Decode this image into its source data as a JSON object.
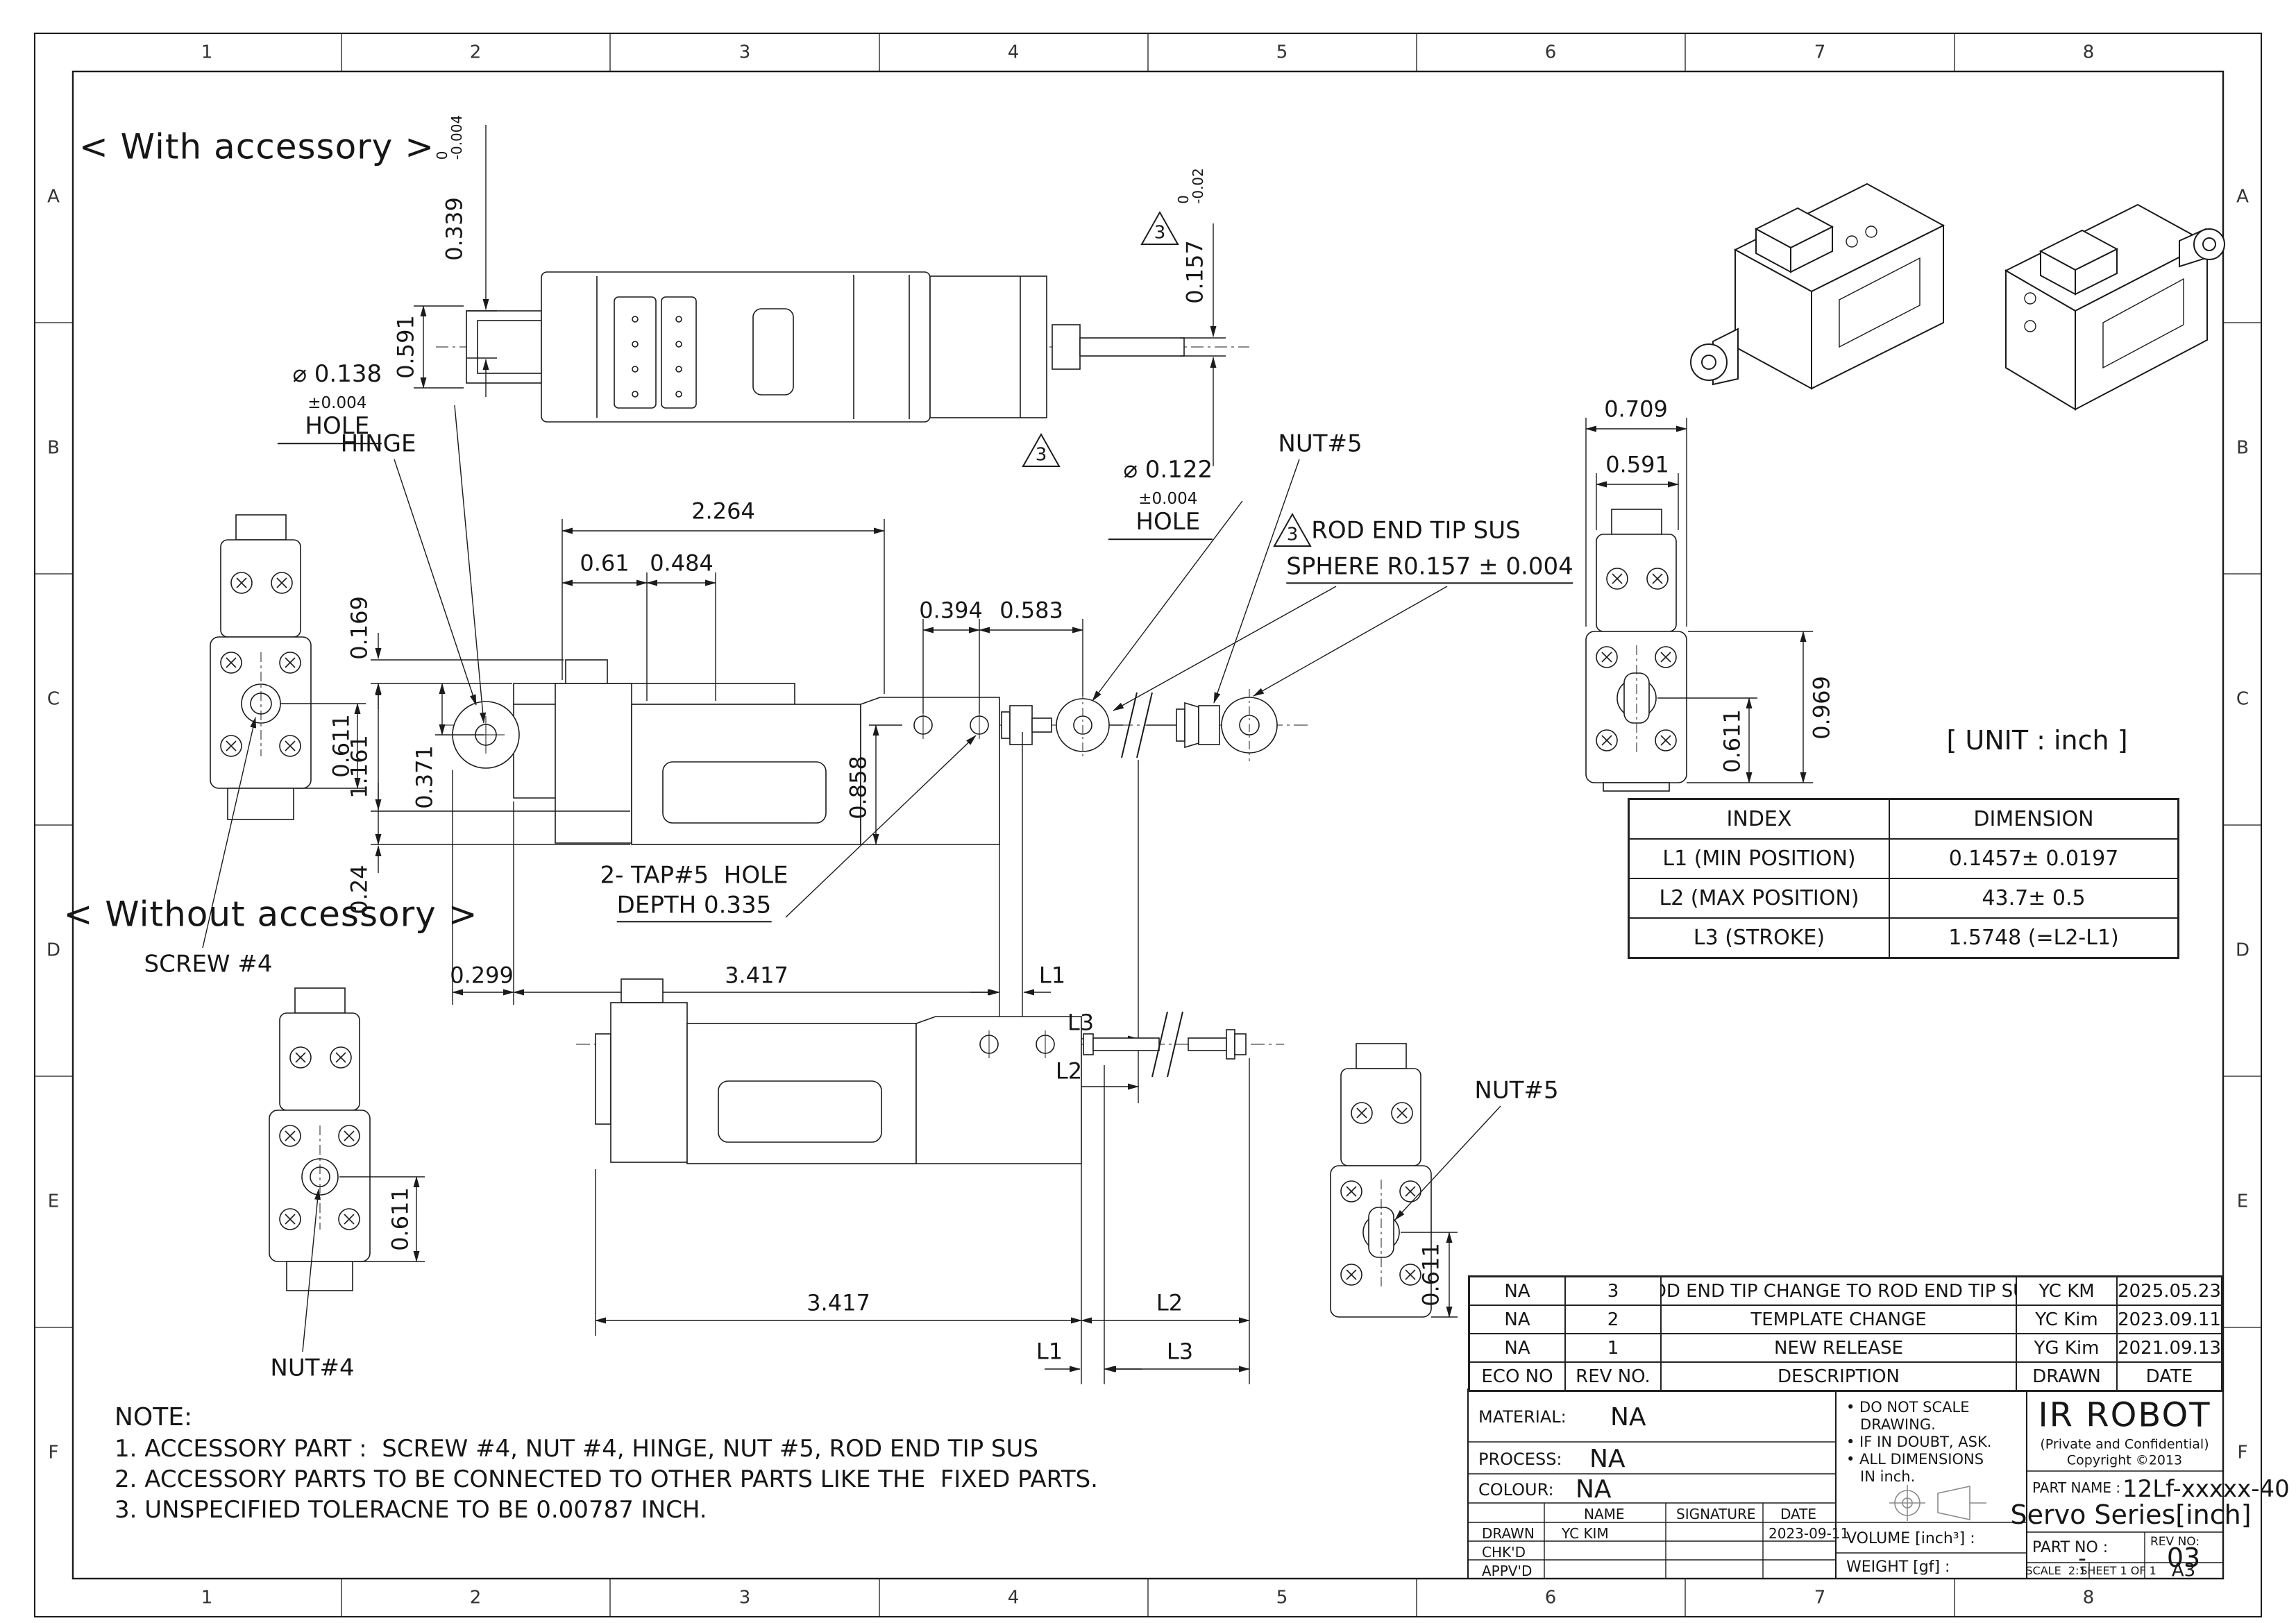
{
  "sheet": {
    "cols": [
      "1",
      "2",
      "3",
      "4",
      "5",
      "6",
      "7",
      "8"
    ],
    "rows": [
      "A",
      "B",
      "C",
      "D",
      "E",
      "F"
    ],
    "unit": "[ UNIT : inch ]"
  },
  "headings": {
    "with": "< With accessory >",
    "without": "< Without accessory >",
    "note_title": "NOTE:"
  },
  "notes": [
    "1. ACCESSORY PART :  SCREW #4, NUT #4, HINGE, NUT #5, ROD END TIP SUS",
    "2. ACCESSORY PARTS TO BE CONNECTED TO OTHER PARTS LIKE THE  FIXED PARTS.",
    "3. UNSPECIFIED TOLERACNE TO BE 0.00787 INCH."
  ],
  "dims": {
    "flag": "3",
    "d0339": "0.339",
    "t0339u": "0",
    "t0339l": "-0.004",
    "d0591": "0.591",
    "d0157": "0.157",
    "t0157u": "0",
    "t0157l": "-0.02",
    "hole138_d": "⌀ 0.138",
    "hole138_t": "±0.004",
    "hole138_s": "HOLE",
    "hinge": "HINGE",
    "d2264": "2.264",
    "d061": "0.61",
    "d0484": "0.484",
    "d0394": "0.394",
    "d0583": "0.583",
    "hole122_d": "⌀ 0.122",
    "hole122_t": "±0.004",
    "hole122_s": "HOLE",
    "nut5": "NUT#5",
    "rodend_line1": "ROD END TIP SUS",
    "rodend_line2": "SPHERE R0.157 ± 0.004",
    "d0169": "0.169",
    "d1161": "1.161",
    "d0371": "0.371",
    "d024": "0.24",
    "d0858": "0.858",
    "d0611": "0.611",
    "screw4": "SCREW #4",
    "tap_line1": "2- TAP#5  HOLE",
    "tap_line2": "DEPTH 0.335",
    "d0299": "0.299",
    "d3417": "3.417",
    "L1": "L1",
    "L2": "L2",
    "L3": "L3",
    "d0709": "0.709",
    "d0969": "0.969",
    "nut4": "NUT#4"
  },
  "index_table": {
    "headers": [
      "INDEX",
      "DIMENSION"
    ],
    "rows": [
      [
        "L1 (MIN POSITION)",
        "0.1457± 0.0197"
      ],
      [
        "L2 (MAX POSITION)",
        "43.7± 0.5"
      ],
      [
        "L3 (STROKE)",
        "1.5748 (=L2-L1)"
      ]
    ]
  },
  "revision_table": {
    "headers": [
      "ECO NO",
      "REV NO.",
      "DESCRIPTION",
      "DRAWN",
      "DATE"
    ],
    "rows": [
      [
        "NA",
        "3",
        "ROD END TIP CHANGE TO ROD END TIP SUS",
        "YC KM",
        "2025.05.23"
      ],
      [
        "NA",
        "2",
        "TEMPLATE CHANGE",
        "YC Kim",
        "2023.09.11"
      ],
      [
        "NA",
        "1",
        "NEW RELEASE",
        "YG Kim",
        "2021.09.13"
      ]
    ]
  },
  "title_block": {
    "material_label": "MATERIAL:",
    "material": "NA",
    "process_label": "PROCESS:",
    "process": "NA",
    "colour_label": "COLOUR:",
    "colour": "NA",
    "name_h": "NAME",
    "signature_h": "SIGNATURE",
    "date_h": "DATE",
    "drawn_label": "DRAWN",
    "chkd_label": "CHK'D",
    "appvd_label": "APPV'D",
    "drawn_name": "YC KIM",
    "drawn_date": "2023-09-11",
    "note_lines": [
      "• DO NOT SCALE",
      "   DRAWING.",
      "• IF IN DOUBT, ASK.",
      "• ALL DIMENSIONS",
      "   IN inch."
    ],
    "volume_label": "VOLUME [inch³] :",
    "weight_label": "WEIGHT [gf] :",
    "company": "IR ROBOT",
    "confidential": "(Private and Confidential)",
    "copyright": "Copyright ©2013",
    "part_name_label": "PART NAME :",
    "part_name": "12Lf-xxxxx-40",
    "part_series": "Servo Series[inch]",
    "part_no_label": "PART NO :",
    "part_no": "-",
    "rev_no_label": "REV NO:",
    "rev_no": "03",
    "scale": "SCALE  2:1",
    "sheet_of": "SHEET 1 OF 1",
    "size": "A3"
  }
}
